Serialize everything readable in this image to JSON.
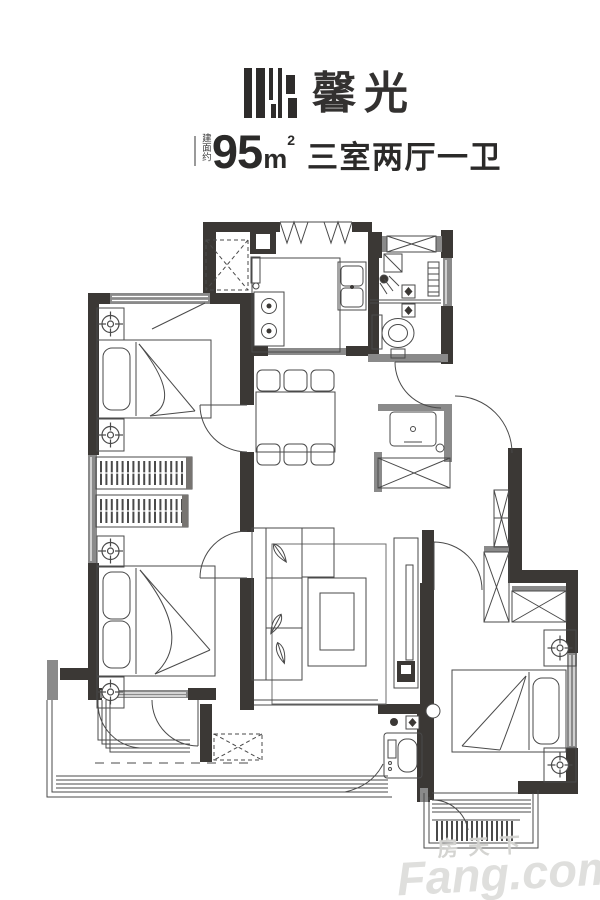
{
  "header": {
    "logo_text": "馨光",
    "area_prefix": "建面约",
    "area_value": "95",
    "area_unit_base": "m",
    "area_unit_exp": "2",
    "layout_text": "三室两厅一卫"
  },
  "watermark": {
    "cn": "房天下",
    "en": "Fang.com"
  },
  "colors": {
    "wall_dark": "#3b3835",
    "wall_gray": "#8a8a8a",
    "line": "#4a4a4a",
    "background": "#ffffff",
    "watermark_gray": "#c7c7c5"
  },
  "floorplan": {
    "type": "apartment-floor-plan",
    "features": [
      "entry-threshold-zigzag",
      "dashed-duct-shaft",
      "refrigerator",
      "kitchen-counter",
      "kitchen-stove-two-burners",
      "kitchen-double-sink",
      "bathroom-window-x",
      "bathroom-shower-head",
      "bathroom-towel-ladder",
      "bathroom-floor-drains",
      "bathroom-toilet",
      "washbasin-niche",
      "riser-shaft-x-box",
      "duct-bowtie-shaft",
      "dining-table-six-chairs",
      "bedroom-top-left-double-bed",
      "wardrobe-hanging-racks",
      "bedroom-bottom-left-double-bed",
      "bedroom-bottom-right-double-bed",
      "nightstands-with-ceiling-light-symbols",
      "living-sofa-with-leaf-pillows",
      "coffee-table",
      "rug",
      "tv-cabinet",
      "washing-machine-niche",
      "ac-platform-dashed-box",
      "balcony-bottom-left-sliding-windows",
      "balcony-bottom-right-railing",
      "door-swing-arcs"
    ]
  }
}
